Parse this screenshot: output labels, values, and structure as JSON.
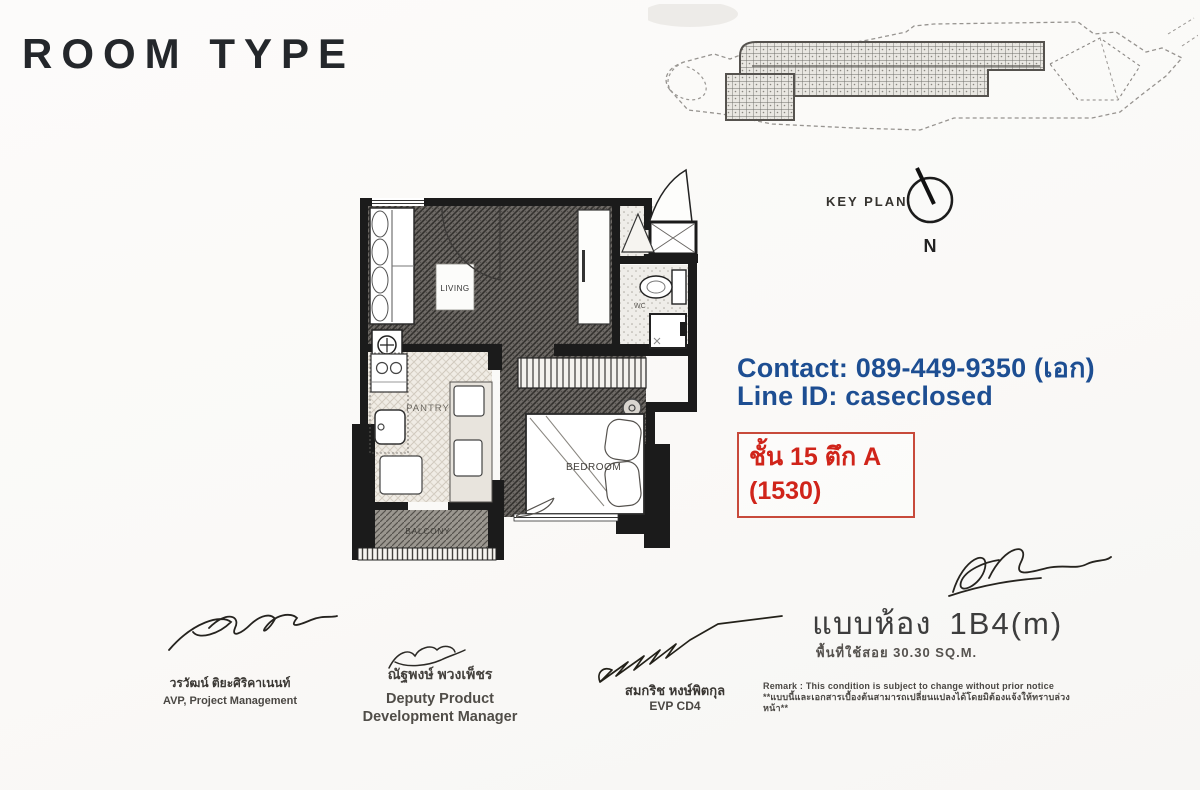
{
  "page": {
    "title": "ROOM TYPE"
  },
  "key_plan": {
    "label": "KEY PLAN",
    "north": "N"
  },
  "floor_plan": {
    "labels": {
      "living": "LIVING",
      "wc": "WC",
      "pantry": "PANTRY",
      "bedroom": "BEDROOM",
      "balcony": "BALCONY"
    }
  },
  "contact": {
    "phone_line": "Contact: 089-449-9350 (เอก)",
    "line_id": "Line ID: caseclosed",
    "accent_color": "#1d4e92"
  },
  "unit_box": {
    "floor_building": "ชั้น 15 ตึก A",
    "unit_no": "(1530)",
    "accent_color": "#d0241a"
  },
  "unit_info": {
    "type_label": "แบบห้อง",
    "type_code": "1B4(m)",
    "area_line": "พื้นที่ใช้สอย  30.30 SQ.M."
  },
  "remark": {
    "line1": "Remark : This condition is subject to change without prior notice",
    "line2": "**แบบนี้และเอกสารเบื้องต้นสามารถเปลี่ยนแปลงได้โดยมิต้องแจ้งให้ทราบล่วงหน้า**"
  },
  "signatories": [
    {
      "name": "วรวัฒน์ ติยะศิริคาเนนท์",
      "title1": "AVP, Project Management",
      "title2": ""
    },
    {
      "name": "ณัฐพงษ์ พวงเพ็ชร",
      "title1": "Deputy Product",
      "title2": "Development Manager"
    },
    {
      "name": "สมกริช หงษ์พิตกุล",
      "title1": "EVP CD4",
      "title2": ""
    }
  ]
}
